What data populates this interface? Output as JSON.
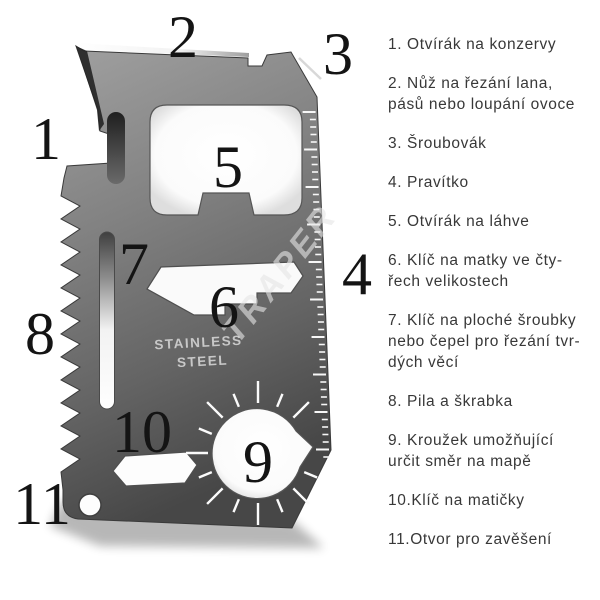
{
  "figure": {
    "numbers": [
      "1",
      "2",
      "3",
      "4",
      "5",
      "6",
      "7",
      "8",
      "9",
      "10",
      "11"
    ],
    "engraving": {
      "line1": "STAINLESS",
      "line2": "STEEL"
    },
    "watermark": "TRAPER"
  },
  "legend": {
    "items": [
      {
        "lines": [
          "1. Otvírák na konzervy"
        ]
      },
      {
        "lines": [
          "2. Nůž na řezání lana,",
          "pásů nebo loupání ovoce"
        ]
      },
      {
        "lines": [
          "3. Šroubovák"
        ]
      },
      {
        "lines": [
          "4. Pravítko"
        ]
      },
      {
        "lines": [
          "5. Otvírák na láhve"
        ]
      },
      {
        "lines": [
          "6. Klíč na matky ve čty-",
          "řech velikostech"
        ]
      },
      {
        "lines": [
          "7. Klíč na ploché šroubky",
          "nebo čepel pro řezání tvr-",
          "dých věcí"
        ]
      },
      {
        "lines": [
          "8. Pila a škrabka"
        ]
      },
      {
        "lines": [
          "9. Kroužek umožňující",
          "určit směr na mapě"
        ]
      },
      {
        "lines": [
          "10.Klíč na matičky"
        ]
      },
      {
        "lines": [
          "11.Otvor pro zavěšení"
        ]
      }
    ]
  },
  "colors": {
    "background": "#ffffff",
    "card_light": "#a0a0a0",
    "card_mid": "#787878",
    "card_dark": "#474747",
    "number_color": "#141414",
    "legend_text": "#383838",
    "engraving": "#c8c8c8",
    "watermark_gray": "#e6e6e6",
    "tick": "#f7f7f7"
  }
}
